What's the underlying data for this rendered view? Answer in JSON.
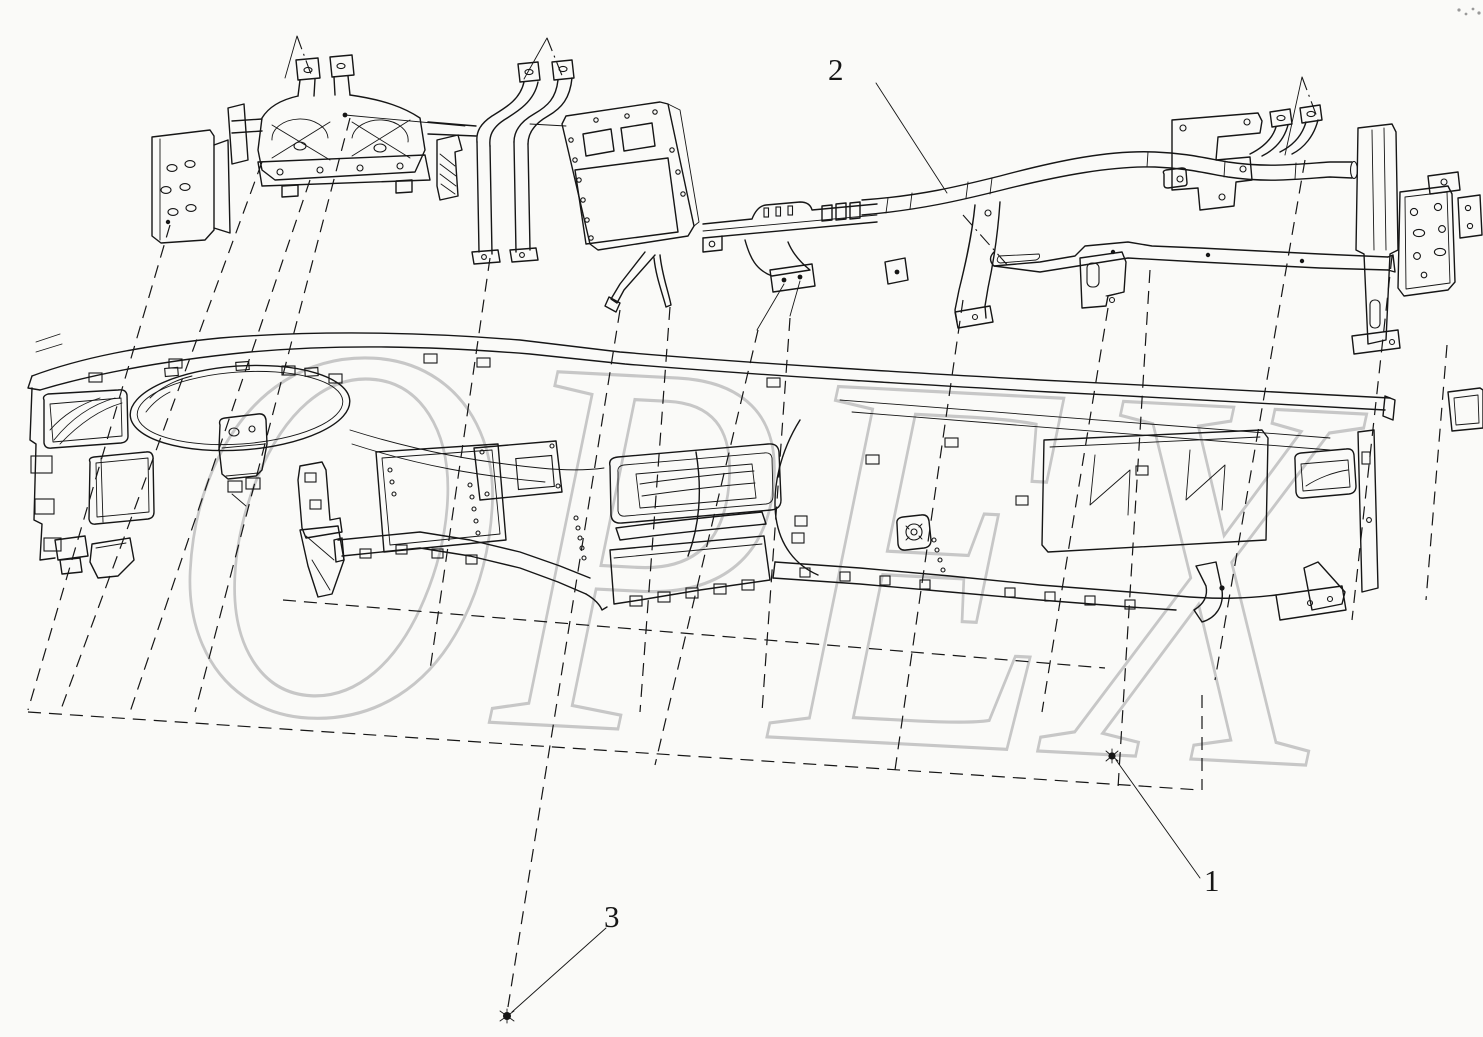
{
  "watermark": {
    "text": "OPEX"
  },
  "callouts": [
    {
      "label": "1"
    },
    {
      "label": "2"
    },
    {
      "label": "3"
    }
  ],
  "icons": {
    "fastener_for_1": "screw-icon",
    "fastener_for_3": "screw-icon"
  },
  "colors": {
    "background": "#fafaf8",
    "line": "#161616",
    "watermark": "#bfbfbf"
  }
}
